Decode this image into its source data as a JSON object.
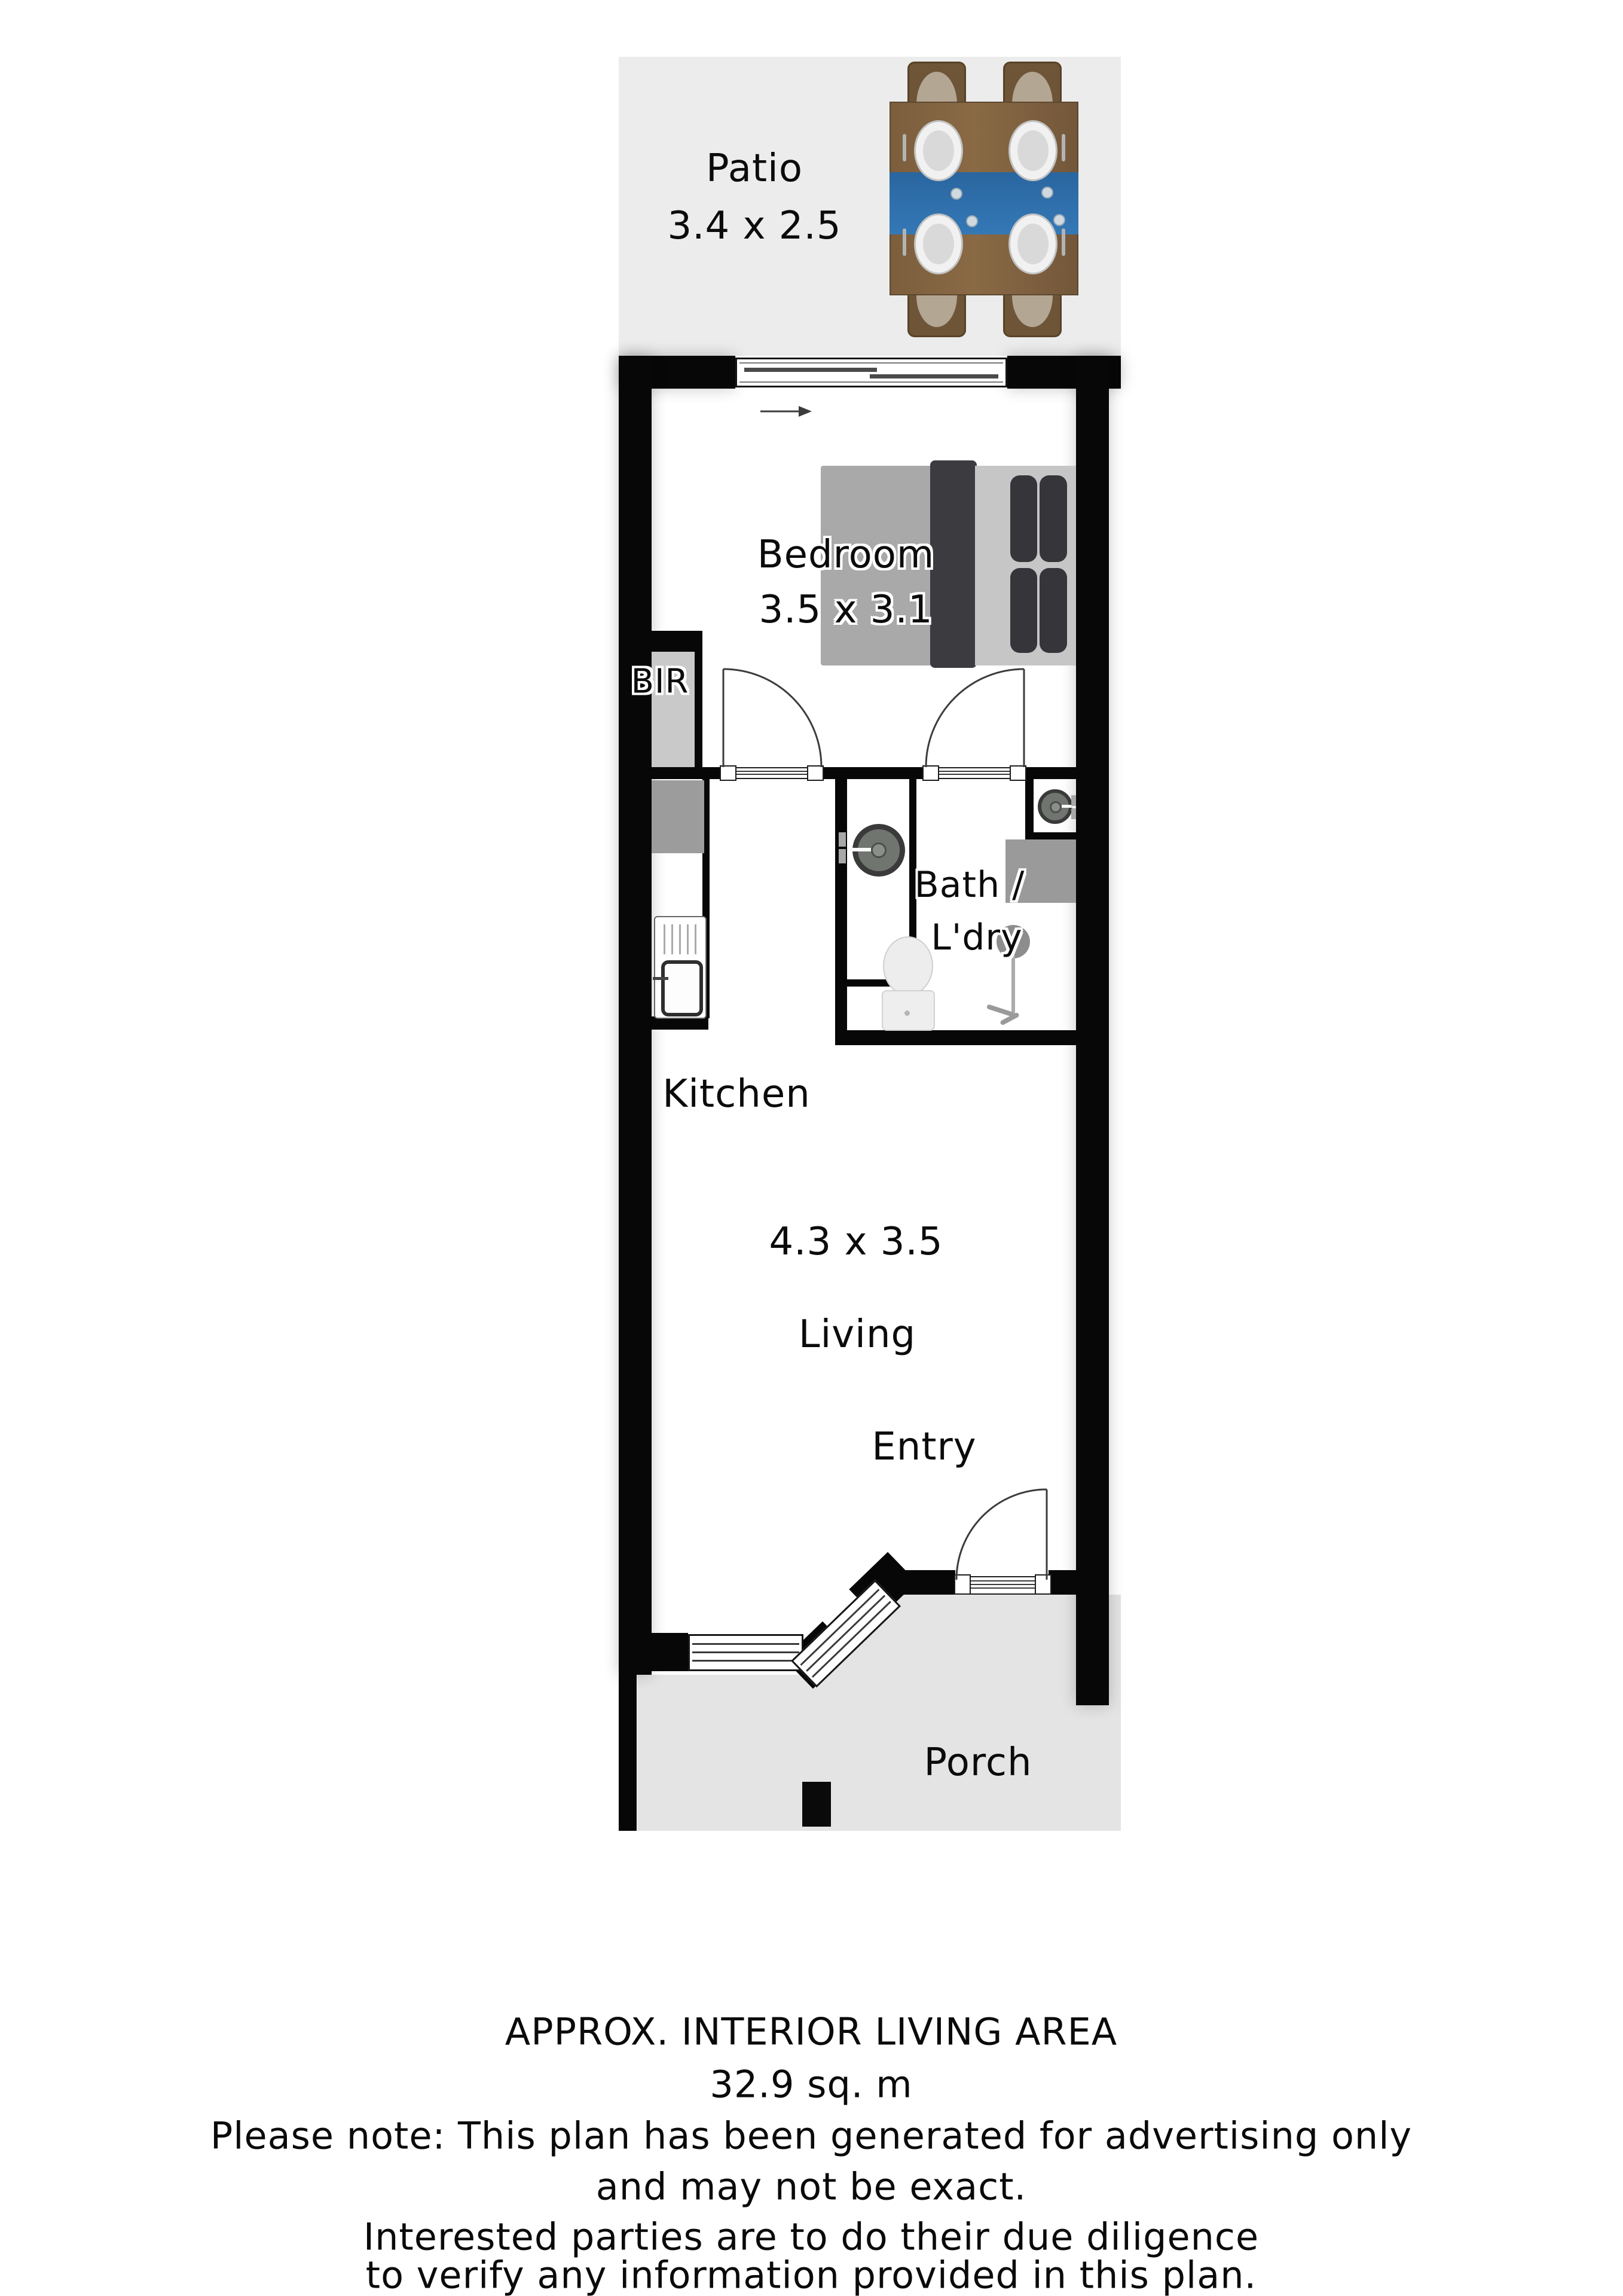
{
  "rooms": {
    "patio": {
      "name": "Patio",
      "dims": "3.4 x 2.5"
    },
    "bedroom": {
      "name": "Bedroom",
      "dims": "3.5 x 3.1"
    },
    "bir": {
      "name": "BIR"
    },
    "bath": {
      "name_line1": "Bath /",
      "name_line2": "L'dry"
    },
    "kitchen": {
      "name": "Kitchen"
    },
    "living": {
      "name": "Living",
      "dims": "4.3 x 3.5"
    },
    "entry": {
      "name": "Entry"
    },
    "porch": {
      "name": "Porch"
    }
  },
  "footer": {
    "line1": "APPROX. INTERIOR LIVING AREA",
    "line2": "32.9 sq. m",
    "line3": "Please note: This plan has been generated for advertising only",
    "line4": "and may not be exact.",
    "line5": "Interested parties are to do their due diligence",
    "line6": "to verify any information provided in this plan."
  },
  "colors": {
    "wall": "#070707",
    "patio_bg": "#ececec",
    "porch_bg": "#e4e4e4",
    "table_wood": "#7c5e3d",
    "runner_blue": "#3076b2",
    "fixture_gray": "#9a9a9a",
    "text": "#0b0b0b"
  },
  "icons": [
    "dining-table-icon",
    "chair-icon",
    "plate-icon",
    "bed-icon",
    "pillow-icon",
    "sliding-window-icon",
    "window-icon",
    "door-swing-icon",
    "built-in-robe",
    "fridge-icon",
    "kitchen-sink-icon",
    "washing-machine-icon",
    "dryer-icon",
    "bench-icon",
    "toilet-icon",
    "shower-icon",
    "porch-post-icon",
    "direction-arrow-icon"
  ]
}
